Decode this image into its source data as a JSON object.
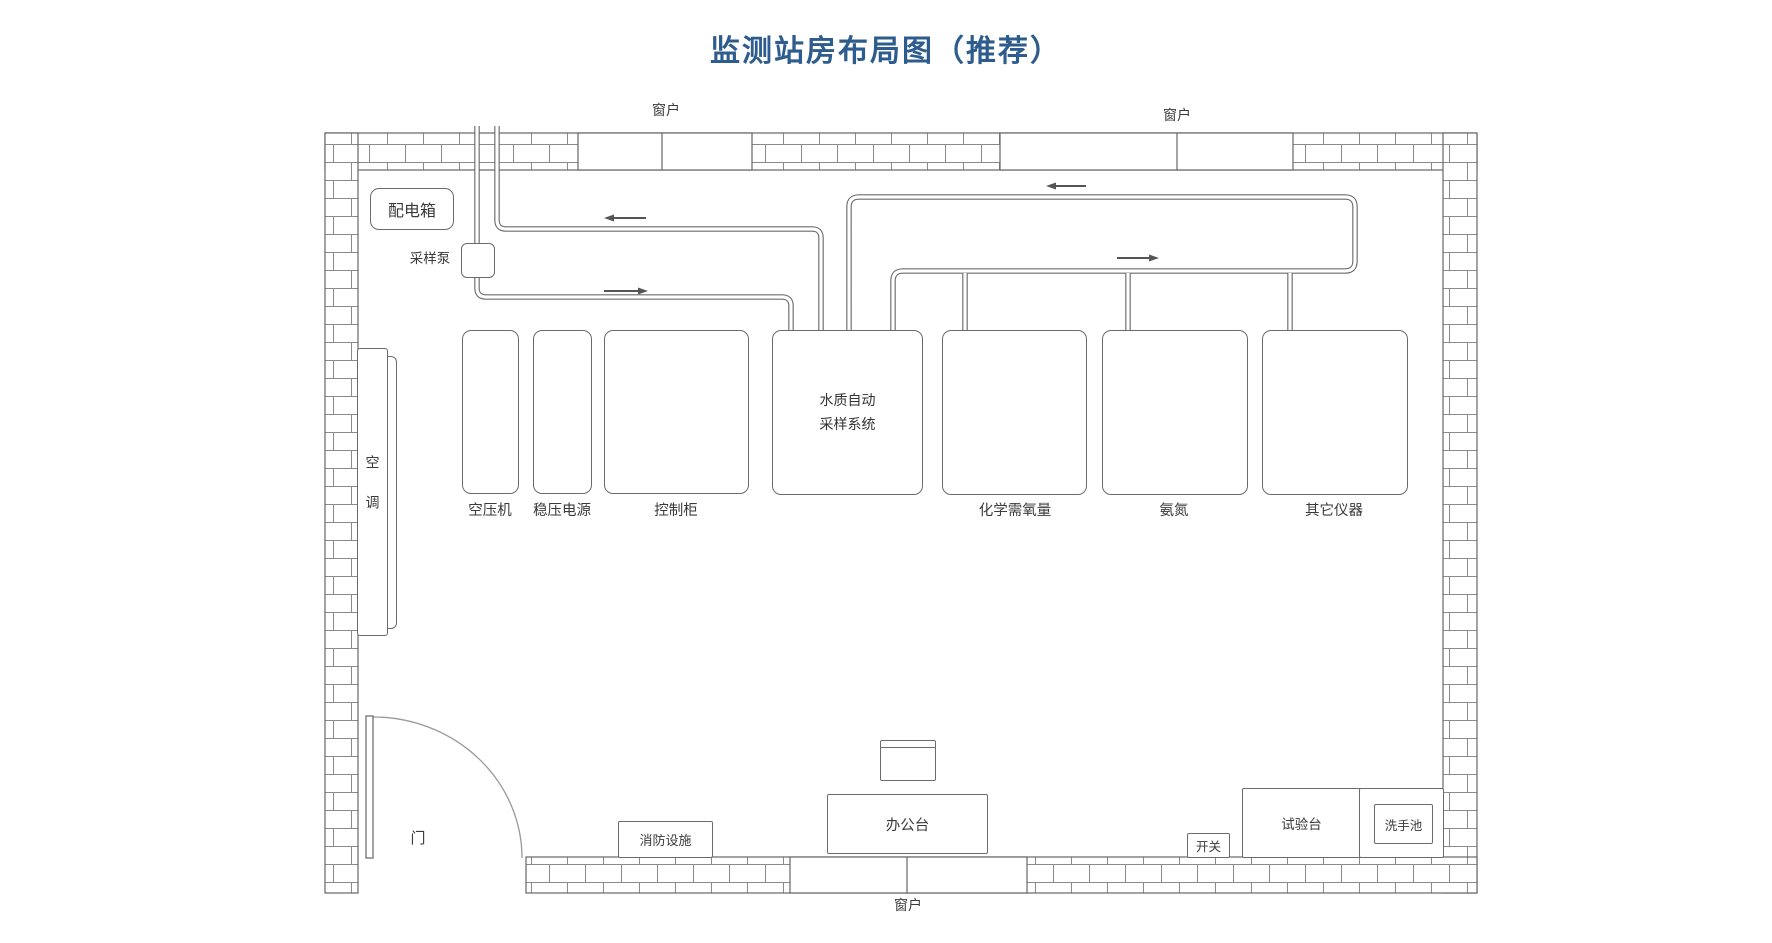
{
  "title": "监测站房布局图（推荐）",
  "colors": {
    "title_blue": "#2d5c8d",
    "line_gray": "#666666"
  },
  "window_label": "窗户",
  "door_label": "门",
  "power": {
    "distribution_box": "配电箱",
    "sampling_pump": "采样泵",
    "switch": "开关"
  },
  "air_conditioner_label": "空调",
  "equipment": [
    {
      "label": "空压机"
    },
    {
      "label": "稳压电源"
    },
    {
      "label": "控制柜"
    },
    {
      "line1": "水质自动",
      "line2": "采样系统"
    },
    {
      "label": "化学需氧量"
    },
    {
      "label": "氨氮"
    },
    {
      "label": "其它仪器"
    }
  ],
  "furniture": {
    "fire_equipment": "消防设施",
    "office_desk": "办公台",
    "test_bench": "试验台",
    "wash_basin": "洗手池"
  }
}
